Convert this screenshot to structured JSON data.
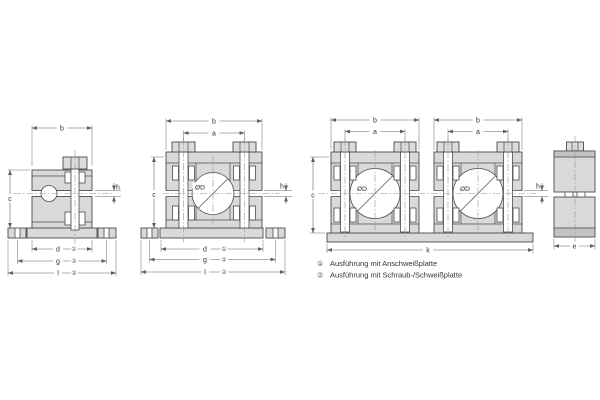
{
  "labels": {
    "b": "b",
    "a": "a",
    "c": "c",
    "d": "d",
    "e": "e",
    "g": "g",
    "h": "h",
    "k": "k",
    "l": "l",
    "diameter": "ØD",
    "note1": "①",
    "note2": "②"
  },
  "legend": {
    "items": [
      {
        "marker": "①",
        "text": "Ausführung mit Anschweißplatte"
      },
      {
        "marker": "②",
        "text": "Ausführung mit Schraub-/Schweißplatte"
      }
    ]
  },
  "colors": {
    "background": "#ffffff",
    "body_fill": "#d9d9d9",
    "band_fill": "#c3c3c3",
    "outline": "#4b4b4b",
    "dimension_line": "#606060",
    "centerline": "#949494"
  }
}
